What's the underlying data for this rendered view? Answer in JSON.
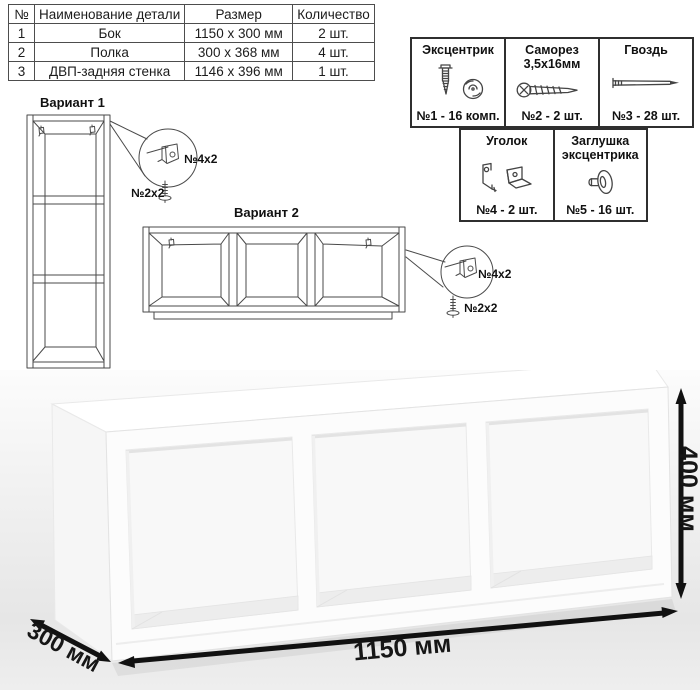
{
  "parts_table": {
    "headers": [
      "№",
      "Наименование детали",
      "Размер",
      "Количество"
    ],
    "rows": [
      {
        "num": "1",
        "name": "Бок",
        "size": "1150 x 300 мм",
        "qty": "2 шт."
      },
      {
        "num": "2",
        "name": "Полка",
        "size": "300 x 368 мм",
        "qty": "4 шт."
      },
      {
        "num": "3",
        "name": "ДВП-задняя стенка",
        "size": "1146 x 396 мм",
        "qty": "1 шт."
      }
    ]
  },
  "hardware_legend": {
    "items": [
      {
        "title_line1": "Эксцентрик",
        "title_line2": "",
        "count": "№1 - 16 комп.",
        "icon": "cam-lock-icon"
      },
      {
        "title_line1": "Саморез",
        "title_line2": "3,5х16мм",
        "count": "№2 - 2 шт.",
        "icon": "screw-icon"
      },
      {
        "title_line1": "Гвоздь",
        "title_line2": "",
        "count": "№3 - 28 шт.",
        "icon": "nail-icon"
      },
      {
        "title_line1": "Уголок",
        "title_line2": "",
        "count": "№4 - 2 шт.",
        "icon": "corner-bracket-icon"
      },
      {
        "title_line1": "Заглушка",
        "title_line2": "эксцентрика",
        "count": "№5 - 16 шт.",
        "icon": "cam-cap-icon"
      }
    ]
  },
  "variant1": {
    "label": "Вариант 1",
    "bracket_callout": "№4х2",
    "screw_callout": "№2х2"
  },
  "variant2": {
    "label": "Вариант 2",
    "bracket_callout": "№4х2",
    "screw_callout": "№2х2"
  },
  "dimensions": {
    "width": "1150 мм",
    "depth": "300 мм",
    "height": "400 мм"
  },
  "colors": {
    "line_art": "#4a4a4a",
    "dimension_arrow": "#111111",
    "photo_bg_top": "#fcfcfc",
    "photo_bg_bottom": "#eeeeee"
  }
}
